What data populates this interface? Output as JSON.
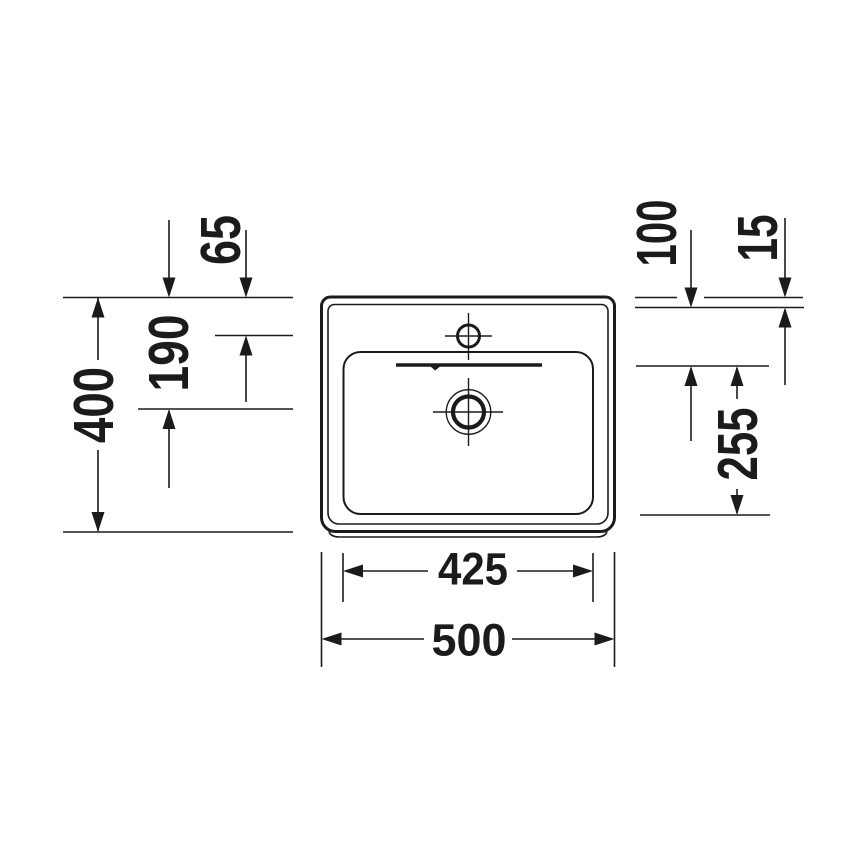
{
  "colors": {
    "ink": "#1b1b1b",
    "paper": "#ffffff"
  },
  "dimensions": {
    "left": {
      "faucet_hole_from_rear": "65",
      "drain_from_rear": "190",
      "overall_depth": "400"
    },
    "right": {
      "overflow_from_rim": "100",
      "rim_thickness": "15",
      "bowl_front_span": "255"
    },
    "bottom": {
      "bowl_width": "425",
      "overall_width": "500"
    }
  }
}
